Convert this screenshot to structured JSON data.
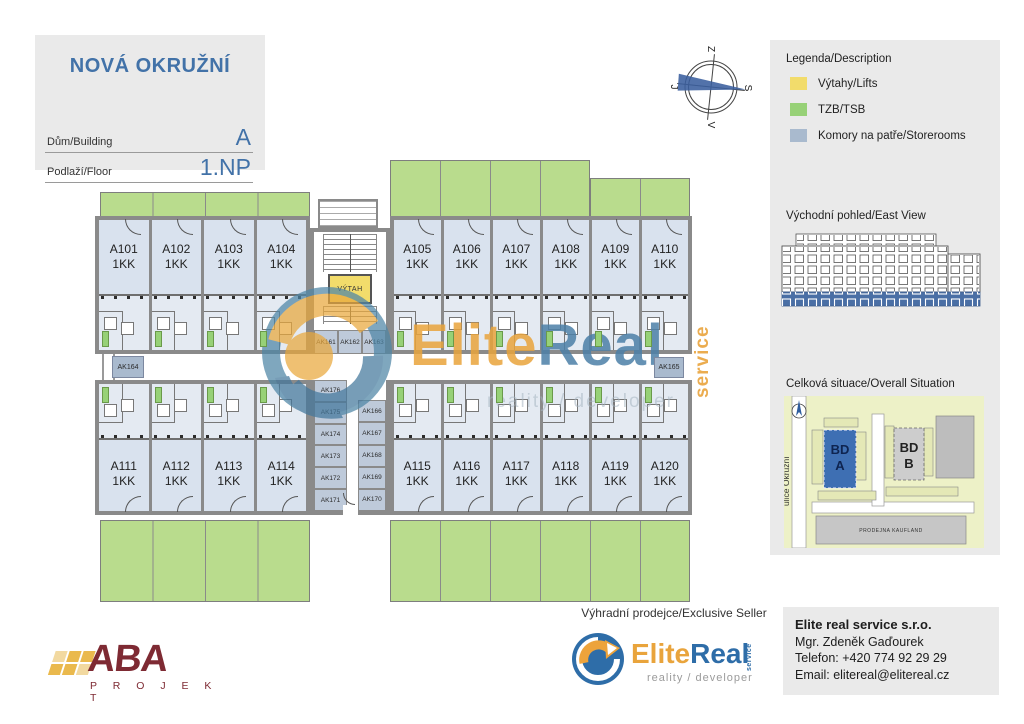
{
  "title_block": {
    "project": "NOVÁ OKRUŽNÍ",
    "building_label": "Dům/Building",
    "building_value": "A",
    "floor_label": "Podlaží/Floor",
    "floor_value": "1.NP"
  },
  "compass": {
    "top": "Z",
    "right": "S",
    "bottom": "V",
    "left": "J"
  },
  "legend": {
    "title": "Legenda/Description",
    "items": [
      {
        "label": "Výtahy/Lifts",
        "color": "#F2DC6B"
      },
      {
        "label": "TZB/TSB",
        "color": "#97D177"
      },
      {
        "label": "Komory na patře/Storerooms",
        "color": "#A9BACE"
      }
    ]
  },
  "east_view": {
    "title": "Východní pohled/East View",
    "highlight_color": "#4A6FA5"
  },
  "situation": {
    "title": "Celková situace/Overall Situation",
    "street": "ulice Okružní",
    "bd_a1": "BD",
    "bd_a2": "A",
    "bd_b1": "BD",
    "bd_b2": "B",
    "store": "PRODEJNA KAUFLAND",
    "bd_a_color": "#3E6FB3"
  },
  "plan": {
    "lift_label": "VÝTAH",
    "units_top": [
      {
        "id": "A101",
        "type": "1KK"
      },
      {
        "id": "A102",
        "type": "1KK"
      },
      {
        "id": "A103",
        "type": "1KK"
      },
      {
        "id": "A104",
        "type": "1KK"
      },
      {
        "id": "A105",
        "type": "1KK"
      },
      {
        "id": "A106",
        "type": "1KK"
      },
      {
        "id": "A107",
        "type": "1KK"
      },
      {
        "id": "A108",
        "type": "1KK"
      },
      {
        "id": "A109",
        "type": "1KK"
      },
      {
        "id": "A110",
        "type": "1KK"
      }
    ],
    "units_bottom": [
      {
        "id": "A111",
        "type": "1KK"
      },
      {
        "id": "A112",
        "type": "1KK"
      },
      {
        "id": "A113",
        "type": "1KK"
      },
      {
        "id": "A114",
        "type": "1KK"
      },
      {
        "id": "A115",
        "type": "1KK"
      },
      {
        "id": "A116",
        "type": "1KK"
      },
      {
        "id": "A117",
        "type": "1KK"
      },
      {
        "id": "A118",
        "type": "1KK"
      },
      {
        "id": "A119",
        "type": "1KK"
      },
      {
        "id": "A120",
        "type": "1KK"
      }
    ],
    "sr_stair": [
      "AK161",
      "AK162",
      "AK163"
    ],
    "sr_left_end": "AK164",
    "sr_right_end": "AK165",
    "sr_left": [
      "AK176",
      "AK175",
      "AK174",
      "AK173",
      "AK172",
      "AK171"
    ],
    "sr_right": [
      "AK166",
      "AK167",
      "AK168",
      "AK169",
      "AK170"
    ]
  },
  "watermark": {
    "elite": "Elite",
    "real": "Real",
    "service": "service",
    "tagline": "reality / developer"
  },
  "footer": {
    "aba": {
      "name": "ABA",
      "sub": "P R O J E K T"
    },
    "seller_line": "Výhradní prodejce/Exclusive Seller",
    "logo": {
      "elite": "Elite",
      "real": "Real",
      "service": "service",
      "tagline": "reality / developer"
    },
    "contact": {
      "company": "Elite real service s.r.o.",
      "person": "Mgr. Zdeněk Gaďourek",
      "phone": "Telefon: +420 774 92 29 29",
      "email": "Email: elitereal@elitereal.cz"
    }
  },
  "colors": {
    "accent_blue": "#4272A8",
    "unit_fill": "#D9E2EE",
    "wall_gray": "#8A8A8A",
    "terrace_green": "#B9DC8D",
    "storeroom_blue": "#A9BACE",
    "lift_yellow": "#F2DC6B",
    "watermark_orange": "#E9A43C",
    "watermark_blue": "#4C80A8",
    "aba_maroon": "#7E2A33",
    "aba_gold": "#EAB94D"
  }
}
